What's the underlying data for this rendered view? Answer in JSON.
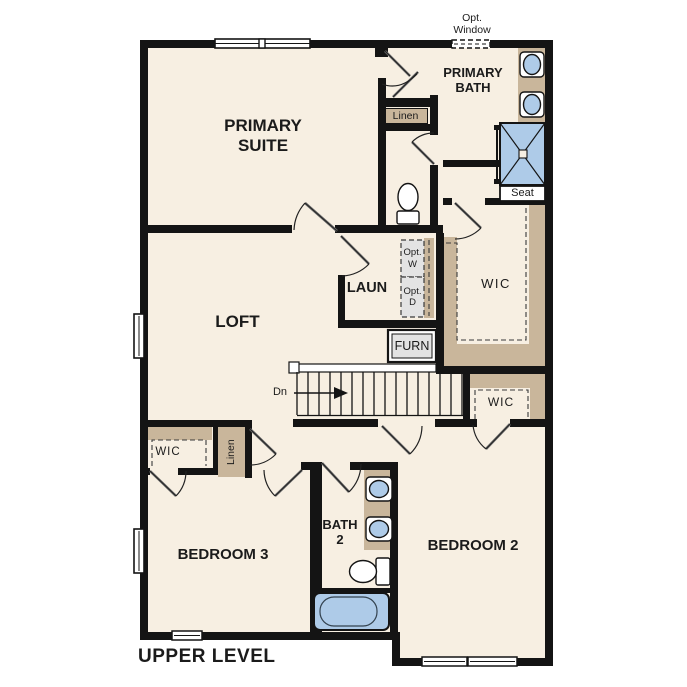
{
  "plan": {
    "title": "UPPER LEVEL",
    "rooms": {
      "primary_suite": "PRIMARY SUITE",
      "primary_bath": "PRIMARY BATH",
      "loft": "LOFT",
      "laundry": "LAUN",
      "bedroom2": "BEDROOM 2",
      "bedroom3": "BEDROOM 3",
      "bath2": "BATH 2",
      "wic_primary": "WIC",
      "wic_bedroom2": "WIC",
      "wic_bedroom3": "WIC"
    },
    "labels": {
      "opt_window": "Opt. Window",
      "linen_hall": "Linen",
      "linen_bedroom3": "Linen",
      "seat": "Seat",
      "furnace": "FURN",
      "stairs_down": "Dn",
      "opt_washer": "Opt. W",
      "opt_dryer": "Opt. D"
    },
    "colors": {
      "wall": "#141414",
      "floor": "#f7efe2",
      "shelving": "#c9b69b",
      "fixture_blue": "#aecbe8",
      "appliance_gray": "#e3e3e3"
    }
  }
}
